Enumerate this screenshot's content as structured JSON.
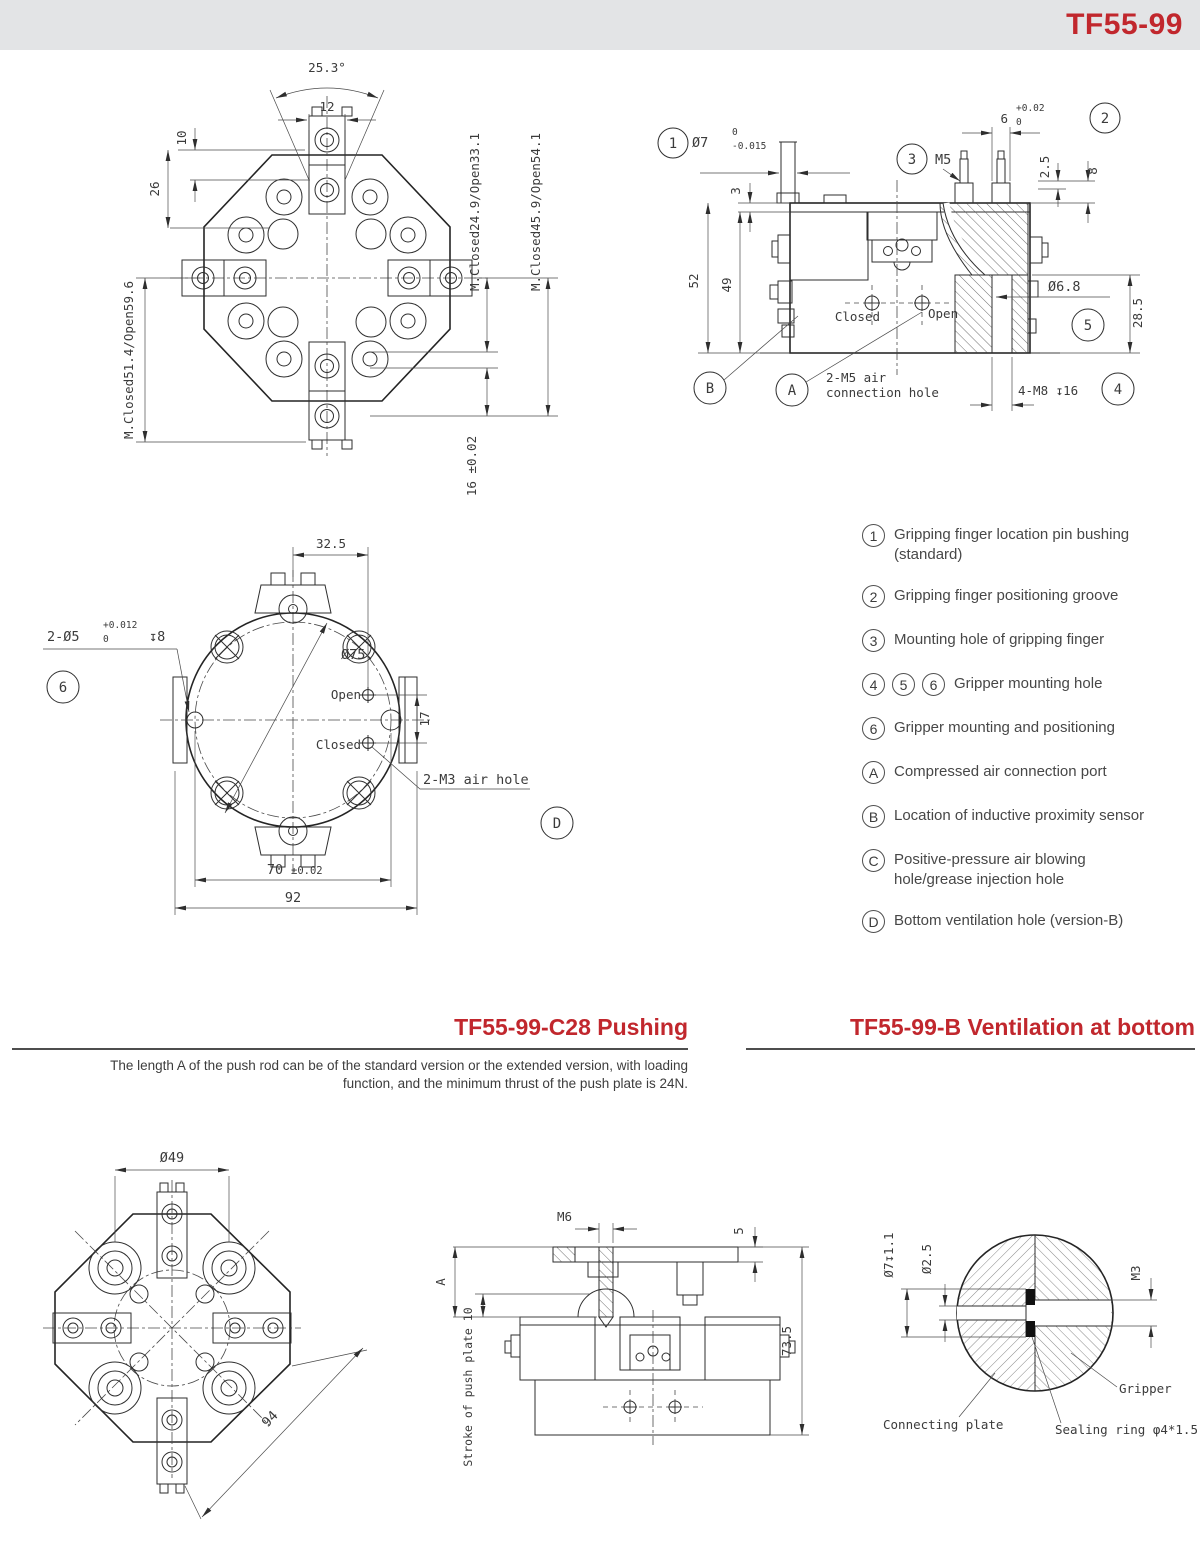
{
  "colors": {
    "accent": "#c1272d",
    "band_bg": "#e3e4e6",
    "line": "#2e2e2e",
    "text": "#3b3b3b"
  },
  "header": {
    "title": "TF55-99"
  },
  "front_view": {
    "angle": "25.3°",
    "top_width": "12",
    "dim10": "10",
    "dim26": "26",
    "left_span": "M.Closed51.4/Open59.6",
    "right_span_inner": "M.Closed24.9/Open33.1",
    "right_span_outer": "M.Closed45.9/Open54.1",
    "bottom_dim": "16 ±0.02"
  },
  "side_view": {
    "callout_1": "1",
    "callout_2": "2",
    "callout_3": "3",
    "callout_4": "4",
    "callout_5": "5",
    "callout_a": "A",
    "callout_b": "B",
    "dia7": "Ø7",
    "dia7_tol_upper": "0",
    "dia7_tol_lower": "-0.015",
    "dim6": "6",
    "dim6_tol_upper": "+0.02",
    "dim6_tol_lower": "0",
    "m5": "M5",
    "dim3": "3",
    "dim2_5": "2.5",
    "dim8": "8",
    "dim52": "52",
    "dim49": "49",
    "dia6_8": "Ø6.8",
    "dim28_5": "28.5",
    "closed_label": "Closed",
    "open_label": "Open",
    "air_note_line1": "2-M5 air",
    "air_note_line2": "connection hole",
    "m8_note": "4-M8 ↧16"
  },
  "bottom_view": {
    "dim32_5": "32.5",
    "pin_note": "2-Ø5",
    "pin_tol_upper": "+0.012",
    "pin_tol_lower": "0",
    "pin_depth": "↧8",
    "callout_6": "6",
    "dia75": "Ø75",
    "open_label": "Open",
    "closed_label": "Closed",
    "dim17": "17",
    "air_note": "2-M3 air hole",
    "callout_d": "D",
    "dim70": "70",
    "dim70_tol": "±0.02",
    "dim92": "92"
  },
  "legend": {
    "items": [
      {
        "badges": [
          "1"
        ],
        "text": "Gripping finger location pin bushing (standard)"
      },
      {
        "badges": [
          "2"
        ],
        "text": "Gripping finger positioning groove"
      },
      {
        "badges": [
          "3"
        ],
        "text": "Mounting hole of gripping finger"
      },
      {
        "badges": [
          "4",
          "5",
          "6"
        ],
        "text": "Gripper mounting hole"
      },
      {
        "badges": [
          "6"
        ],
        "text": "Gripper mounting and positioning"
      },
      {
        "badges": [
          "A"
        ],
        "text": "Compressed air connection port"
      },
      {
        "badges": [
          "B"
        ],
        "text": "Location of inductive proximity sensor"
      },
      {
        "badges": [
          "C"
        ],
        "text": "Positive-pressure air blowing hole/grease injection hole"
      },
      {
        "badges": [
          "D"
        ],
        "text": "Bottom ventilation hole (version-B)"
      }
    ]
  },
  "sections": {
    "pushing_title": "TF55-99-C28 Pushing",
    "vent_title": "TF55-99-B Ventilation at bottom",
    "pushing_desc_line1": "The length A of the push rod can be of the standard version or the extended version, with loading",
    "pushing_desc_line2": "function, and the minimum thrust of the push plate is 24N."
  },
  "pushing_front": {
    "dia49": "Ø49",
    "dim94": "94"
  },
  "pushing_side": {
    "m6": "M6",
    "dim5": "5",
    "dimA": "A",
    "stroke_label": "Stroke of push plate 10",
    "dim73_5": "73.5"
  },
  "vent_detail": {
    "dia7_depth": "Ø7↧1.1",
    "dia2_5": "Ø2.5",
    "m3": "M3",
    "gripper_label": "Gripper",
    "plate_label": "Connecting plate",
    "seal_label": "Sealing ring φ4*1.5"
  }
}
